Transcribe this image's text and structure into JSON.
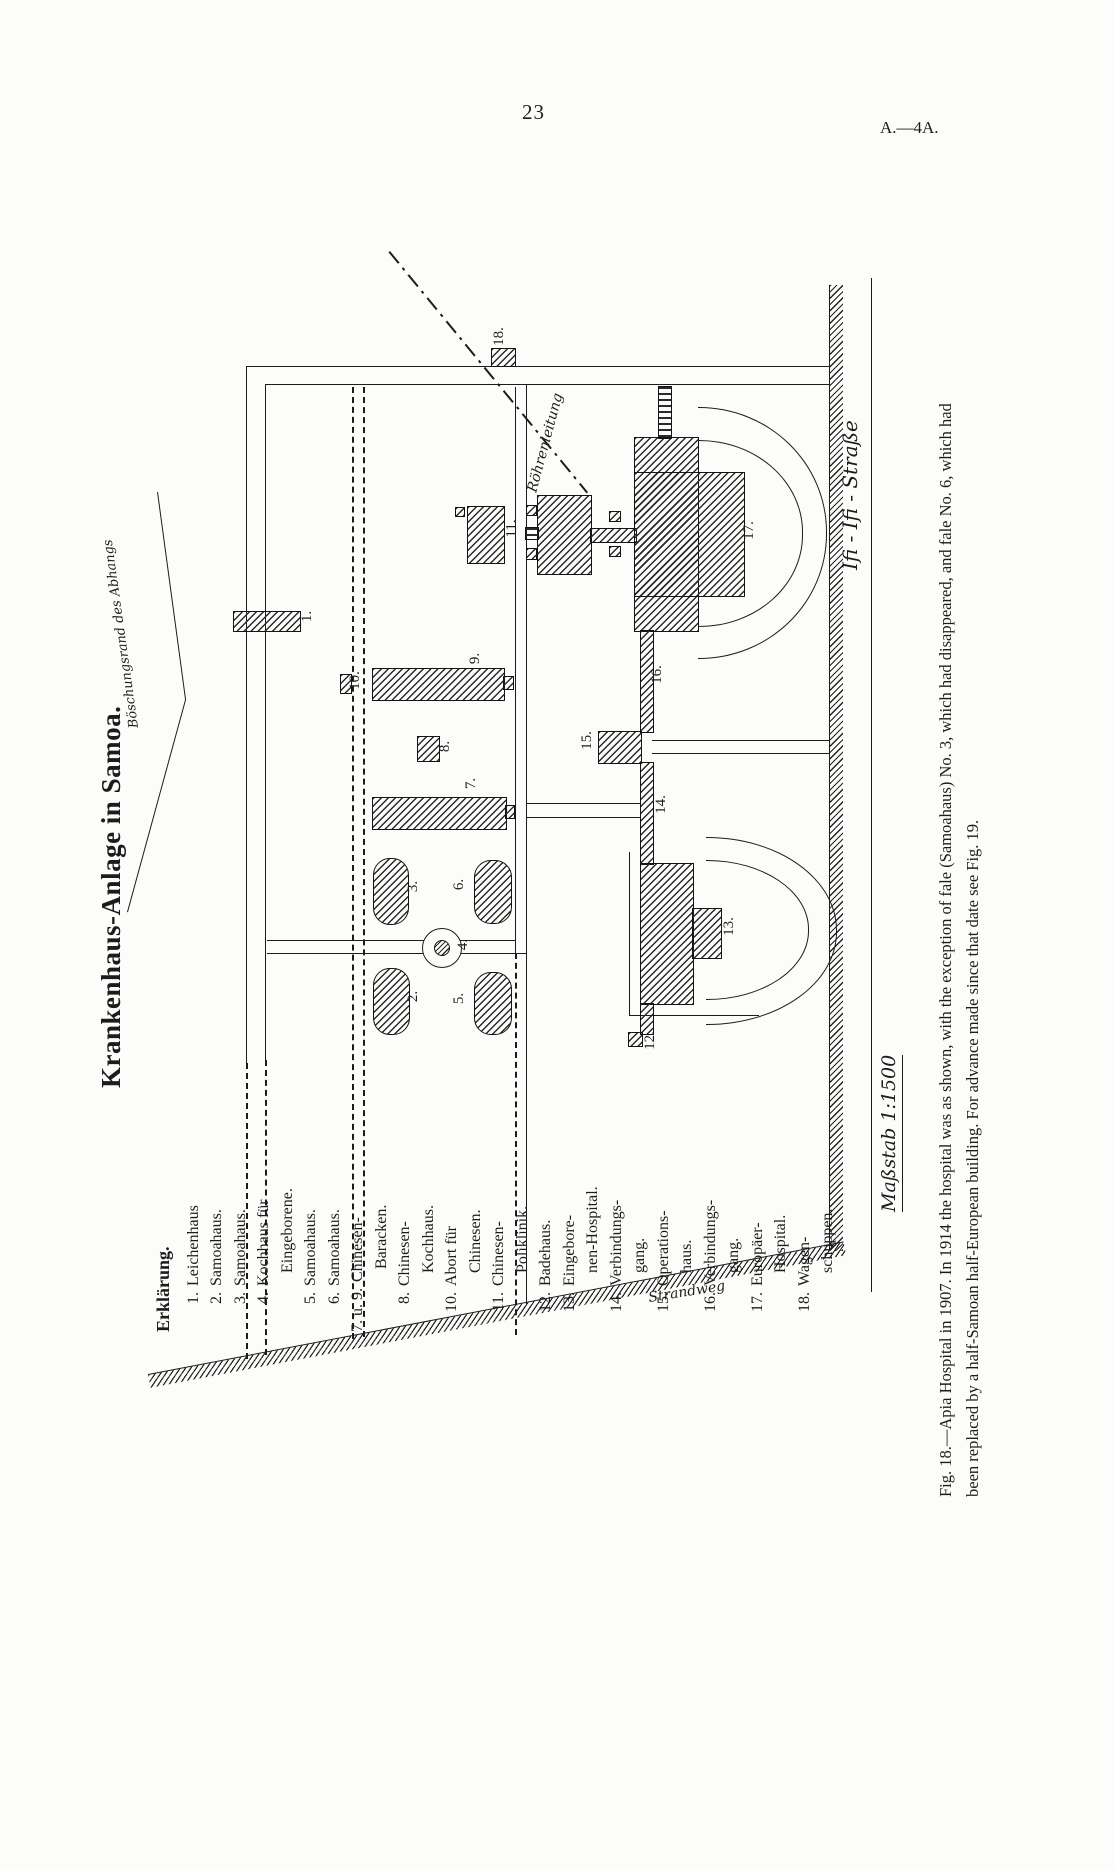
{
  "page": {
    "number": "23",
    "plate": "A.—4A."
  },
  "title": "Krankenhaus-Anlage in Samoa.",
  "legend": {
    "heading": "Erklärung.",
    "items": [
      {
        "num": "1.",
        "line1": "Leichenhaus",
        "line2": ""
      },
      {
        "num": "2.",
        "line1": "Samoahaus.",
        "line2": ""
      },
      {
        "num": "3.",
        "line1": "Samoahaus.",
        "line2": ""
      },
      {
        "num": "4.",
        "line1": "Kochhaus für",
        "line2": "Eingeborene."
      },
      {
        "num": "5.",
        "line1": "Samoahaus.",
        "line2": ""
      },
      {
        "num": "6.",
        "line1": "Samoahaus.",
        "line2": ""
      },
      {
        "num": "7. u. 9.",
        "line1": "Chinesen-",
        "line2": "Baracken."
      },
      {
        "num": "8.",
        "line1": "Chinesen-",
        "line2": "Kochhaus."
      },
      {
        "num": "10.",
        "line1": "Abort für",
        "line2": "Chinesen."
      },
      {
        "num": "11.",
        "line1": "Chinesen-",
        "line2": "Poliklinik."
      },
      {
        "num": "12.",
        "line1": "Badehaus.",
        "line2": ""
      },
      {
        "num": "13.",
        "line1": "Eingebore-",
        "line2": "nen-Hospital."
      },
      {
        "num": "14.",
        "line1": "Verbindungs-",
        "line2": "gang."
      },
      {
        "num": "15.",
        "line1": "Operations-",
        "line2": "haus."
      },
      {
        "num": "16.",
        "line1": "Verbindungs-",
        "line2": "gang."
      },
      {
        "num": "17.",
        "line1": "Europäer-",
        "line2": "Hospital."
      },
      {
        "num": "18.",
        "line1": "Wagen-",
        "line2": "schuppen."
      }
    ]
  },
  "map": {
    "street_name": "Ifi - Ifi - Straße",
    "scale": "Maßstab 1:1500",
    "pipe_label": "Röhrenleitung",
    "slope_label": "Böschungsrand des Abhangs",
    "shore_label": "Strandweg",
    "labels": {
      "b1": "1.",
      "b2": "2.",
      "b3": "3.",
      "b4": "4.",
      "b5": "5.",
      "b6": "6.",
      "b7": "7.",
      "b8": "8.",
      "b9": "9.",
      "b10": "10.",
      "b11": "11.",
      "b12": "12.",
      "b13": "13.",
      "b14": "14.",
      "b15": "15.",
      "b16": "16.",
      "b17": "17.",
      "b18": "18."
    }
  },
  "caption": {
    "line1": "Fig. 18.—Apia Hospital in 1907.  In 1914 the hospital was as shown, with the exception of fale (Samoahaus) No. 3, which had disappeared, and fale No. 6, which had",
    "line2": "been replaced by a half-Samoan half-European building.  For advance made since that date see Fig. 19."
  },
  "colors": {
    "ink": "#1c1c1c",
    "paper": "#fcfcfa"
  }
}
